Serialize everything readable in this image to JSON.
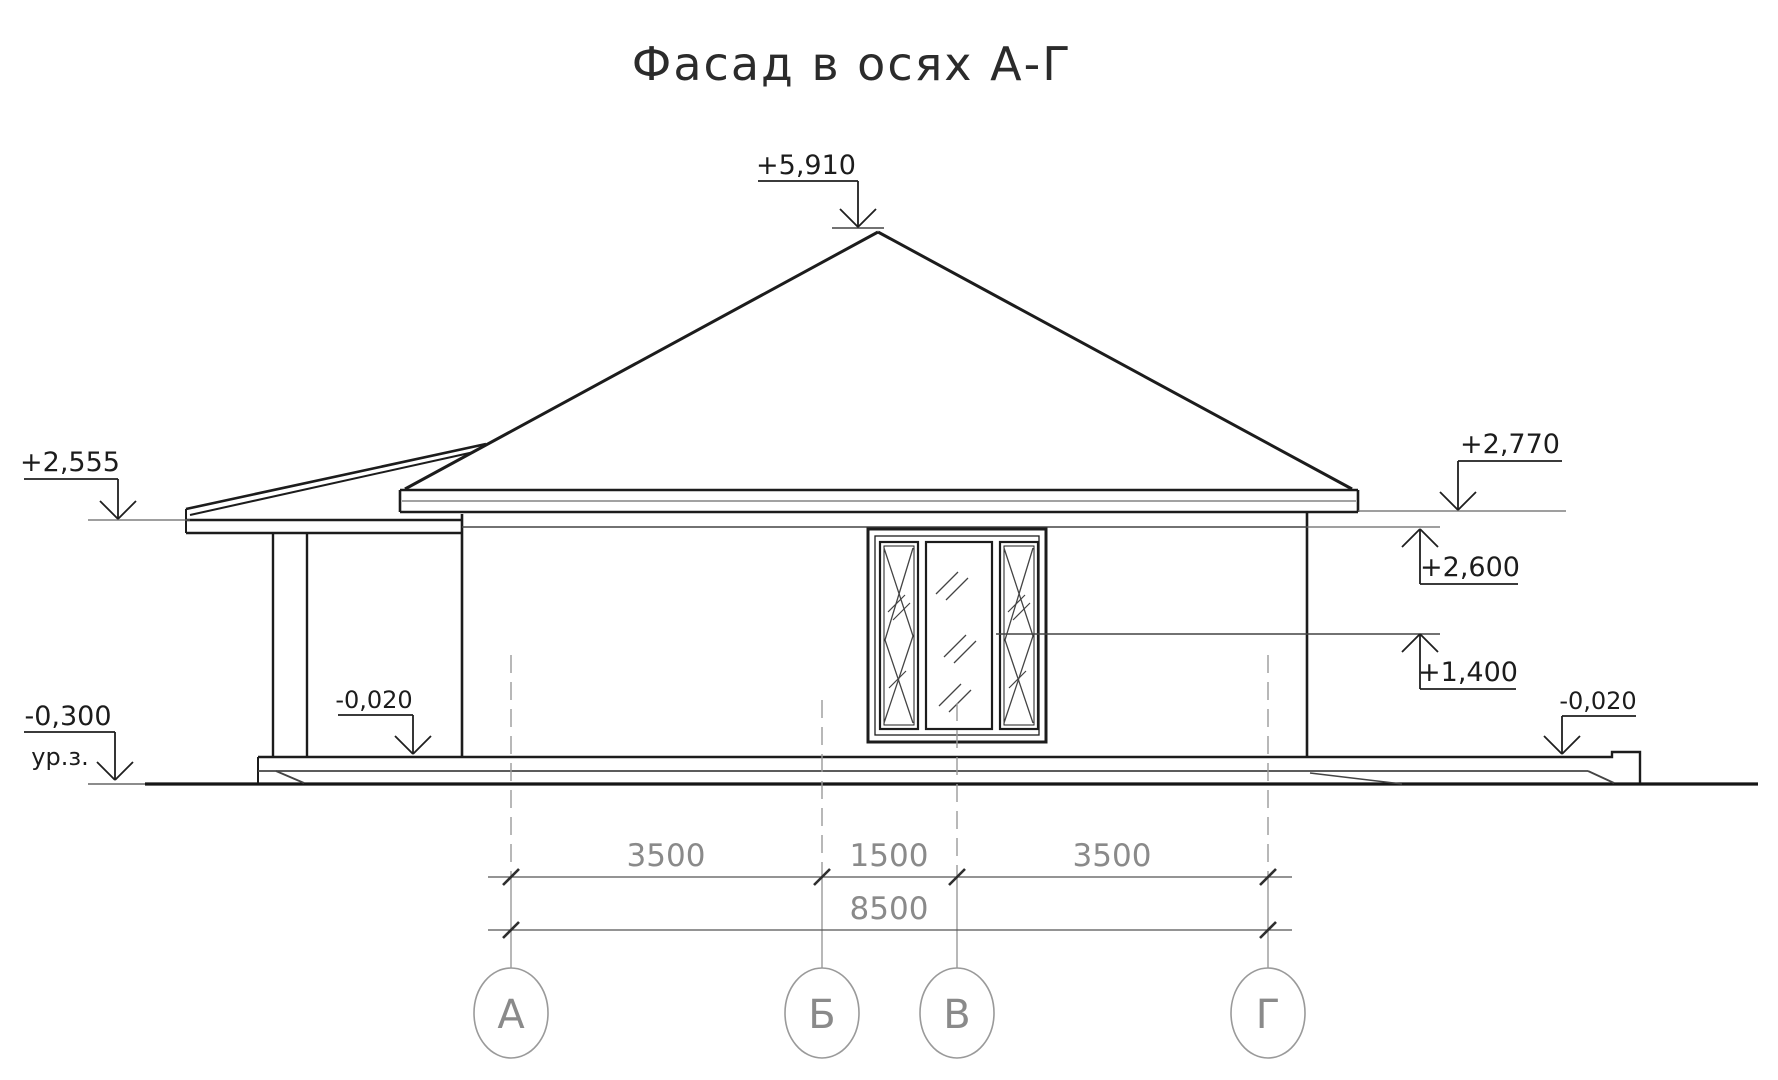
{
  "title": "Фасад в осях А-Г",
  "elevation_marks": {
    "ridge": "+5,910",
    "porch_eave": "+2,555",
    "main_eave": "+2,770",
    "wall_top": "+2,600",
    "window_mid": "+1,400",
    "porch_floor": "-0,020",
    "terrace_floor": "-0,020",
    "ground": "-0,300",
    "ground_level_label": "ур.з."
  },
  "dimensions": {
    "row1": [
      "3500",
      "1500",
      "3500"
    ],
    "total": "8500"
  },
  "axes": {
    "labels": [
      "А",
      "Б",
      "В",
      "Г"
    ]
  },
  "colors": {
    "line": "#1c1c1c",
    "gray_annotation": "#8c8c8c",
    "dim_text": "#8a8a8a",
    "background": "#ffffff"
  }
}
